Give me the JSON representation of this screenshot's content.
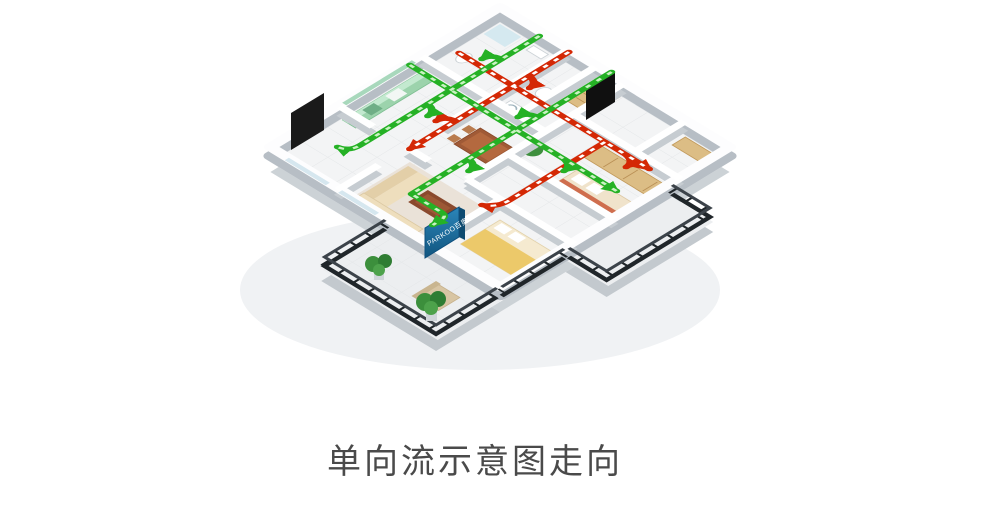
{
  "caption": {
    "text": "单向流示意图走向"
  },
  "device": {
    "brand_label": "PARKOO百奥",
    "panel_color_top": "#2b85b9",
    "panel_color_bottom": "#11557f"
  },
  "airflow": {
    "supply_color": "#25b125",
    "supply_dash_color": "#c9f2c2",
    "exhaust_color": "#d42805",
    "exhaust_dash_color": "#ffffff"
  },
  "scene": {
    "wall_color": "#ffffff",
    "floor_color": "#f3f4f5",
    "balcony_frame_color": "#20262a",
    "caption_color": "#4a4a4a"
  }
}
